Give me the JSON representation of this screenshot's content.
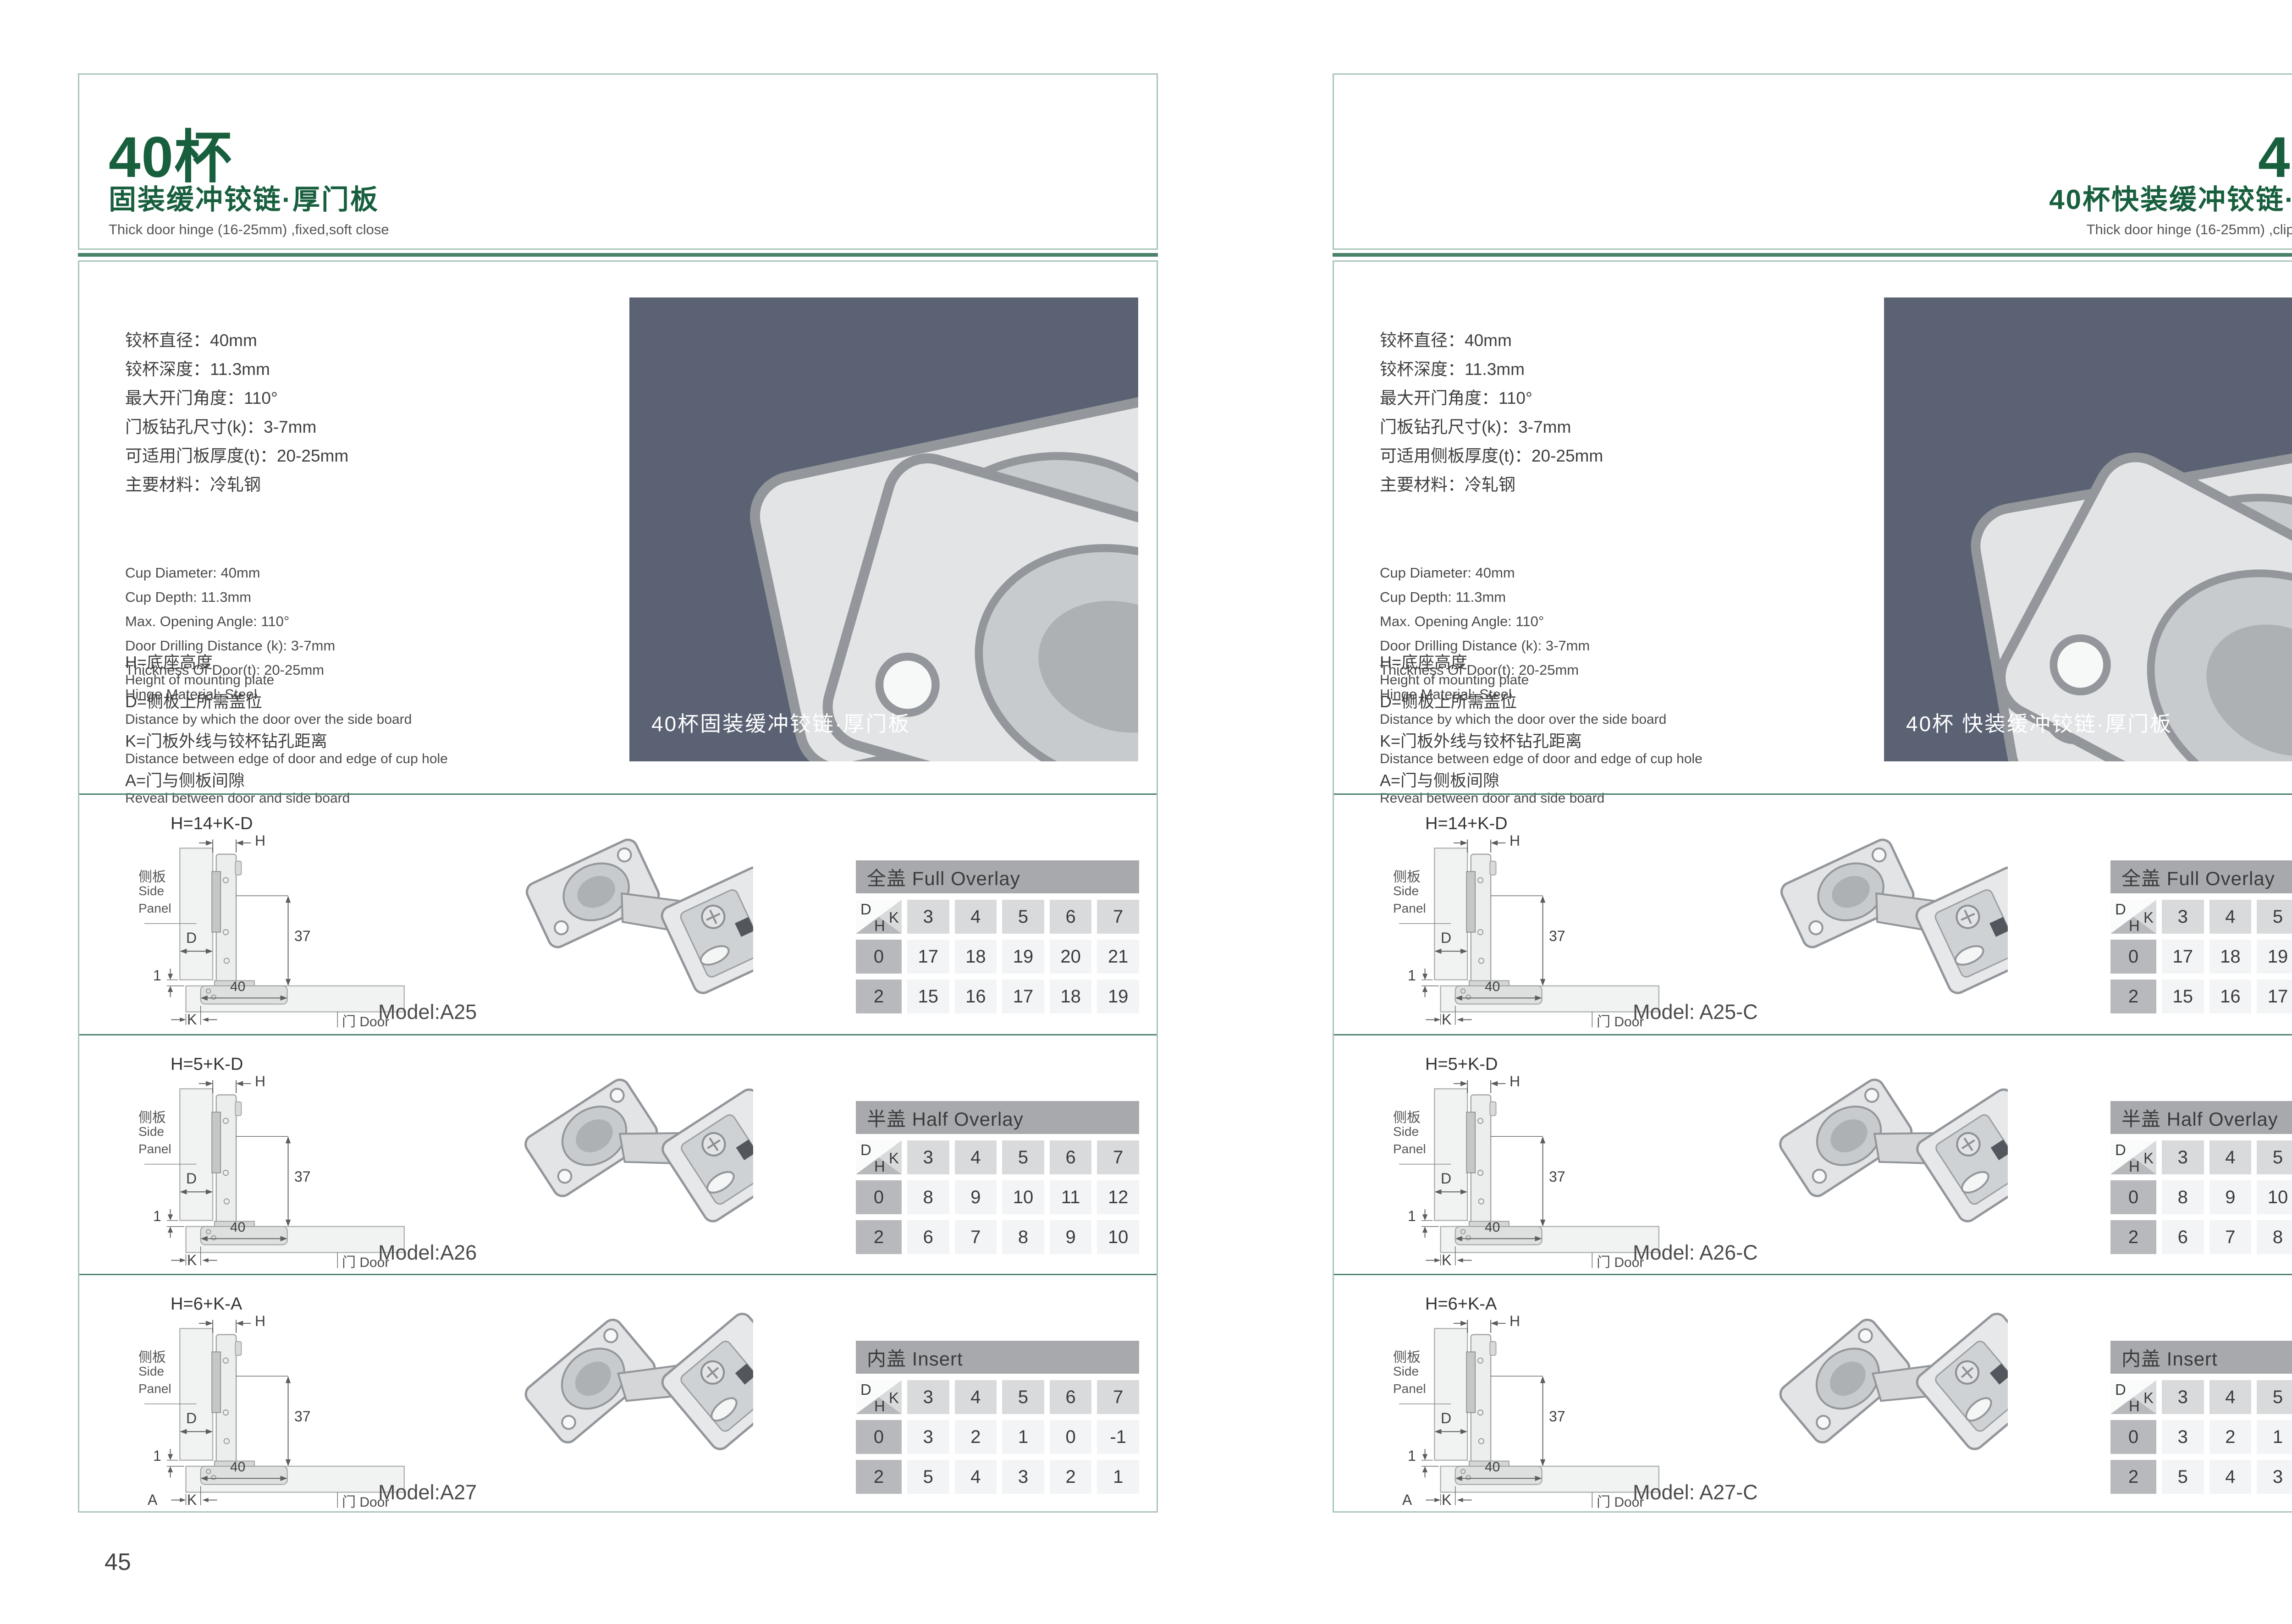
{
  "colors": {
    "accent_green": "#185f3e",
    "rule_green": "#4a8169",
    "box_border": "#a9c6b9",
    "divider": "#4a8169",
    "photo_bg": "#5a6274",
    "table_bar": "#a7a9ac",
    "table_colhead": "#d9dadb",
    "table_rowlabel": "#b7b9bc",
    "table_value_bg": "#f3f4f5",
    "text_dark": "#3b3b3d"
  },
  "diagram": {
    "h_label": "H",
    "d_label": "D",
    "k_label": "K",
    "one_label": "1",
    "dim_37": "37",
    "dim_40": "40",
    "side_panel_cn": "侧板",
    "side_panel_en_1": "Side",
    "side_panel_en_2": "Panel",
    "door_label": "门 Door"
  },
  "pages": [
    {
      "page_number": "45",
      "header": {
        "title": "40杯",
        "subtitle_cn": "固装缓冲铰链·厚门板",
        "subtitle_en": "Thick door hinge (16-25mm)  ,fixed,soft close"
      },
      "specs_cn": [
        "铰杯直径：40mm",
        "铰杯深度：11.3mm",
        "最大开门角度：110°",
        "门板钻孔尺寸(k)：3-7mm",
        "可适用门板厚度(t)：20-25mm",
        "主要材料：冷轧钢"
      ],
      "specs_en": [
        "Cup Diameter: 40mm",
        "Cup Depth: 11.3mm",
        "Max. Opening Angle: 110°",
        "Door Drilling Distance (k): 3-7mm",
        "Thickness Of Door(t): 20-25mm",
        "Hinge Material: Steel"
      ],
      "legend": [
        {
          "cn": "H=底座高度",
          "en": "Height of mounting plate"
        },
        {
          "cn": "D=侧板上所需盖位",
          "en": "Distance by which the door over the side board"
        },
        {
          "cn": "K=门板外线与铰杯钻孔距离",
          "en": "Distance between edge of door and edge of cup hole"
        },
        {
          "cn": "A=门与侧板间隙",
          "en": "Reveal between door and side board"
        }
      ],
      "photo": {
        "caption": "40杯固装缓冲铰链·厚门板"
      },
      "rows": [
        {
          "formula": "H=14+K-D",
          "model": "Model:A25",
          "table": {
            "title": "全盖 Full Overlay",
            "corner": {
              "tl": "D",
              "tr": "K",
              "b": "H"
            },
            "cols": [
              "3",
              "4",
              "5",
              "6",
              "7"
            ],
            "rows": [
              {
                "label": "0",
                "values": [
                  "17",
                  "18",
                  "19",
                  "20",
                  "21"
                ]
              },
              {
                "label": "2",
                "values": [
                  "15",
                  "16",
                  "17",
                  "18",
                  "19"
                ]
              }
            ]
          }
        },
        {
          "formula": "H=5+K-D",
          "model": "Model:A26",
          "table": {
            "title": "半盖 Half Overlay",
            "corner": {
              "tl": "D",
              "tr": "K",
              "b": "H"
            },
            "cols": [
              "3",
              "4",
              "5",
              "6",
              "7"
            ],
            "rows": [
              {
                "label": "0",
                "values": [
                  "8",
                  "9",
                  "10",
                  "11",
                  "12"
                ]
              },
              {
                "label": "2",
                "values": [
                  "6",
                  "7",
                  "8",
                  "9",
                  "10"
                ]
              }
            ]
          }
        },
        {
          "formula": "H=6+K-A",
          "model": "Model:A27",
          "extra_dim": "A",
          "table": {
            "title": "内盖 Insert",
            "corner": {
              "tl": "D",
              "tr": "K",
              "b": "H"
            },
            "cols": [
              "3",
              "4",
              "5",
              "6",
              "7"
            ],
            "rows": [
              {
                "label": "0",
                "values": [
                  "3",
                  "2",
                  "1",
                  "0",
                  "-1"
                ]
              },
              {
                "label": "2",
                "values": [
                  "5",
                  "4",
                  "3",
                  "2",
                  "1"
                ]
              }
            ]
          }
        }
      ]
    },
    {
      "page_number": "46",
      "header": {
        "title": "40杯",
        "subtitle_cn": "40杯快装缓冲铰链·厚门板",
        "subtitle_en": "Thick door hinge (16-25mm)  ,clip on ,soft close"
      },
      "specs_cn": [
        "铰杯直径：40mm",
        "铰杯深度：11.3mm",
        "最大开门角度：110°",
        "门板钻孔尺寸(k)：3-7mm",
        "可适用侧板厚度(t)：20-25mm",
        "主要材料：冷轧钢"
      ],
      "specs_en": [
        "Cup Diameter: 40mm",
        "Cup Depth: 11.3mm",
        "Max. Opening Angle: 110°",
        "Door Drilling Distance (k): 3-7mm",
        "Thickness Of Door(t): 20-25mm",
        "Hinge Material: Steel"
      ],
      "legend": [
        {
          "cn": "H=底座高度",
          "en": "Height of mounting plate"
        },
        {
          "cn": "D=侧板上所需盖位",
          "en": "Distance by which the door over the side board"
        },
        {
          "cn": "K=门板外线与铰杯钻孔距离",
          "en": "Distance between edge of door and edge of cup hole"
        },
        {
          "cn": "A=门与侧板间隙",
          "en": "Reveal between door and side board"
        }
      ],
      "photo": {
        "caption": "40杯 快装缓冲铰链·厚门板"
      },
      "rows": [
        {
          "formula": "H=14+K-D",
          "model": "Model: A25-C",
          "table": {
            "title": "全盖 Full Overlay",
            "corner": {
              "tl": "D",
              "tr": "K",
              "b": "H"
            },
            "cols": [
              "3",
              "4",
              "5",
              "6",
              "7"
            ],
            "rows": [
              {
                "label": "0",
                "values": [
                  "17",
                  "18",
                  "19",
                  "20",
                  "21"
                ]
              },
              {
                "label": "2",
                "values": [
                  "15",
                  "16",
                  "17",
                  "18",
                  "19"
                ]
              }
            ]
          }
        },
        {
          "formula": "H=5+K-D",
          "model": "Model: A26-C",
          "table": {
            "title": "半盖 Half Overlay",
            "corner": {
              "tl": "D",
              "tr": "K",
              "b": "H"
            },
            "cols": [
              "3",
              "4",
              "5",
              "6",
              "7"
            ],
            "rows": [
              {
                "label": "0",
                "values": [
                  "8",
                  "9",
                  "10",
                  "11",
                  "12"
                ]
              },
              {
                "label": "2",
                "values": [
                  "6",
                  "7",
                  "8",
                  "9",
                  "10"
                ]
              }
            ]
          }
        },
        {
          "formula": "H=6+K-A",
          "model": "Model: A27-C",
          "extra_dim": "A",
          "table": {
            "title": "内盖 Insert",
            "corner": {
              "tl": "D",
              "tr": "K",
              "b": "H"
            },
            "cols": [
              "3",
              "4",
              "5",
              "6",
              "7"
            ],
            "rows": [
              {
                "label": "0",
                "values": [
                  "3",
                  "2",
                  "1",
                  "0",
                  "-1"
                ]
              },
              {
                "label": "2",
                "values": [
                  "5",
                  "4",
                  "3",
                  "2",
                  "1"
                ]
              }
            ]
          }
        }
      ]
    }
  ]
}
